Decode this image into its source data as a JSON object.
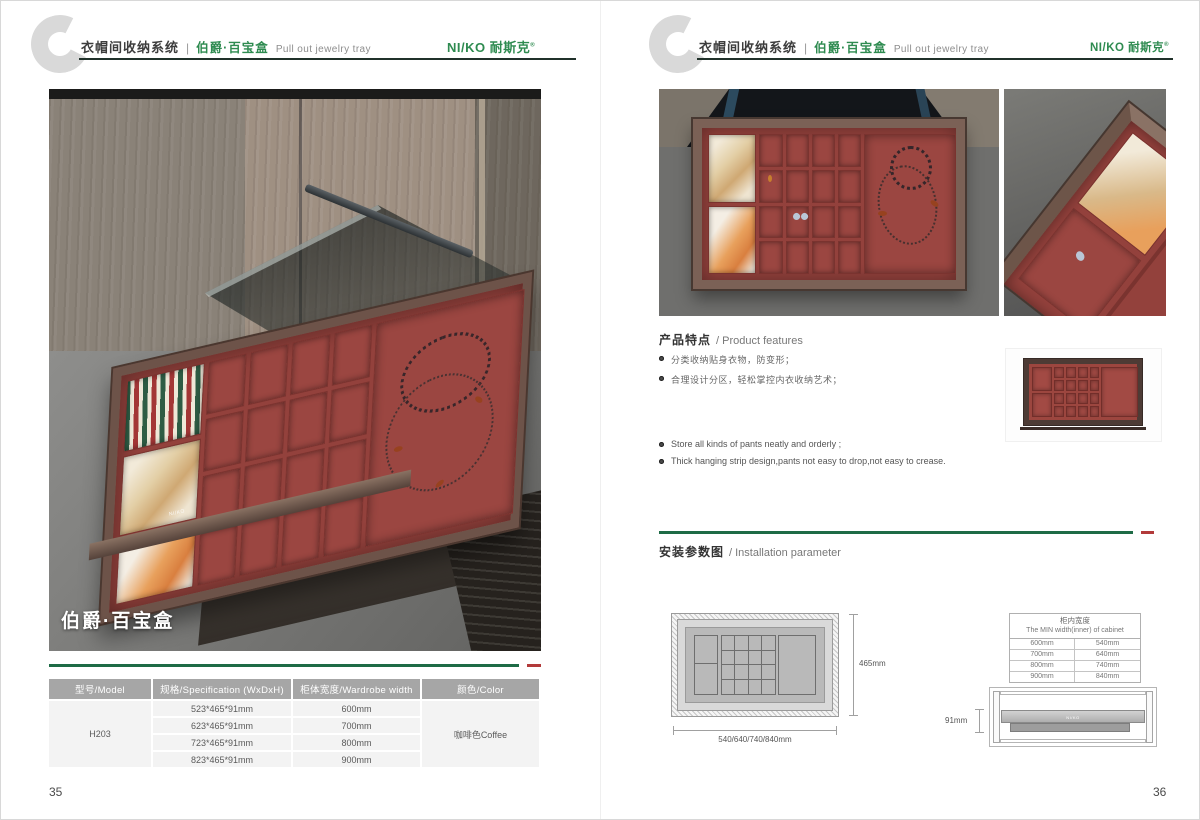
{
  "brand": {
    "name": "NI/KO 耐斯克",
    "registered": "®"
  },
  "header": {
    "letter": "C",
    "category": "衣帽间收纳系统",
    "divider": "|",
    "product": "伯爵·百宝盒",
    "subtitle": "Pull out jewelry tray"
  },
  "colors": {
    "brand_green": "#2E8B50",
    "rule_green": "#1E6B46",
    "accent_red": "#B23A3A",
    "table_header_gray": "#A6A6A6",
    "velvet_red": "#93413C"
  },
  "left_page": {
    "photo_caption": "伯爵·百宝盒",
    "page_number": "35",
    "table": {
      "headers": [
        "型号/Model",
        "规格/Specification (WxDxH)",
        "柜体宽度/Wardrobe width",
        "颜色/Color"
      ],
      "model": "H203",
      "color": "咖啡色Coffee",
      "rows": [
        {
          "spec": "523*465*91mm",
          "width": "600mm"
        },
        {
          "spec": "623*465*91mm",
          "width": "700mm"
        },
        {
          "spec": "723*465*91mm",
          "width": "800mm"
        },
        {
          "spec": "823*465*91mm",
          "width": "900mm"
        }
      ]
    }
  },
  "right_page": {
    "page_number": "36",
    "features": {
      "title_cn": "产品特点",
      "title_en": "/ Product features",
      "bullets_cn": [
        "分类收纳贴身衣物，防变形；",
        "合理设计分区，轻松掌控内衣收纳艺术；"
      ],
      "bullets_en": [
        "Store all kinds of pants neatly and orderly ;",
        "Thick hanging strip design,pants not easy to drop,not easy to crease."
      ]
    },
    "installation": {
      "title_cn": "安装参数图",
      "title_en": "/ Installation parameter",
      "top_view": {
        "height_label": "465mm",
        "width_label": "540/640/740/840mm"
      },
      "side_view": {
        "height_label": "91mm"
      },
      "width_table": {
        "title_cn": "柜内宽度",
        "title_en": "The MIN width(inner) of cabinet",
        "rows": [
          [
            "600mm",
            "540mm"
          ],
          [
            "700mm",
            "640mm"
          ],
          [
            "800mm",
            "740mm"
          ],
          [
            "900mm",
            "840mm"
          ]
        ]
      }
    }
  }
}
